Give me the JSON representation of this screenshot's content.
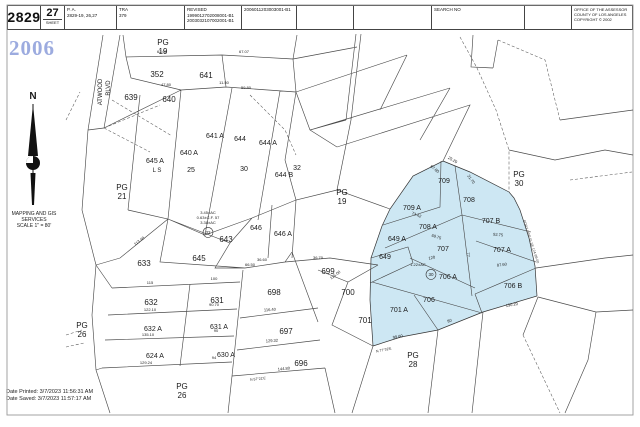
{
  "header": {
    "map_book": "2829",
    "sheet_value": "27",
    "sheet_label": "SHEET",
    "pa_label": "P. A.",
    "pa_value": "2829-19, 26,27",
    "tra_label": "TRA",
    "tra_value": "379",
    "revised_label": "REVISED",
    "revised_1": "1999012702008001-B1",
    "revised_2": "2003032107002001-B1",
    "revised_3": "2006011203003001-B1",
    "search_label": "SEARCH NO",
    "office_1": "OFFICE OF THE ASSESSOR",
    "office_2": "COUNTY OF LOS ANGELES",
    "office_3": "COPYRIGHT © 2002"
  },
  "sidebar": {
    "year": "2006",
    "org_1": "MAPPING AND GIS",
    "org_2": "SERVICES",
    "org_3": "SCALE 1\" = 80'",
    "date_printed": "Date Printed: 3/7/2023 11:56:31 AM",
    "date_saved": "Date Saved: 3/7/2023 11:57:17 AM"
  },
  "map": {
    "highlight_color": "#cde7f3",
    "labels": [
      {
        "t": "N",
        "x": 33,
        "y": 99,
        "s": 10,
        "b": true,
        "n": "north-label"
      },
      {
        "t": "PG",
        "x": 163,
        "y": 45,
        "s": 8
      },
      {
        "t": "19",
        "x": 163,
        "y": 54,
        "s": 8
      },
      {
        "t": "ATWOOD",
        "x": 102,
        "y": 92,
        "s": 6,
        "r": -90,
        "n": "street-label"
      },
      {
        "t": "BLVD",
        "x": 110,
        "y": 88,
        "s": 6,
        "r": -90,
        "n": "street-label"
      },
      {
        "t": "352",
        "x": 157,
        "y": 77,
        "s": 8
      },
      {
        "t": "641",
        "x": 206,
        "y": 78,
        "s": 8
      },
      {
        "t": "639",
        "x": 131,
        "y": 100,
        "s": 8
      },
      {
        "t": "640",
        "x": 169,
        "y": 102,
        "s": 8
      },
      {
        "t": "641 A",
        "x": 215,
        "y": 138,
        "s": 7
      },
      {
        "t": "644",
        "x": 240,
        "y": 141,
        "s": 7
      },
      {
        "t": "644 A",
        "x": 268,
        "y": 145,
        "s": 7
      },
      {
        "t": "640 A",
        "x": 189,
        "y": 155,
        "s": 7
      },
      {
        "t": "645 A",
        "x": 155,
        "y": 163,
        "s": 7
      },
      {
        "t": "L S",
        "x": 157,
        "y": 172,
        "s": 6
      },
      {
        "t": "25",
        "x": 191,
        "y": 172,
        "s": 7
      },
      {
        "t": "30",
        "x": 244,
        "y": 171,
        "s": 7
      },
      {
        "t": "32",
        "x": 297,
        "y": 170,
        "s": 7
      },
      {
        "t": "644 B",
        "x": 284,
        "y": 177,
        "s": 7
      },
      {
        "t": "PG",
        "x": 122,
        "y": 190,
        "s": 8
      },
      {
        "t": "21",
        "x": 122,
        "y": 199,
        "s": 8
      },
      {
        "t": "PG",
        "x": 342,
        "y": 195,
        "s": 8
      },
      {
        "t": "19",
        "x": 342,
        "y": 204,
        "s": 8
      },
      {
        "t": "PG",
        "x": 519,
        "y": 177,
        "s": 8
      },
      {
        "t": "30",
        "x": 519,
        "y": 186,
        "s": 8
      },
      {
        "t": "3.45±AC",
        "x": 208,
        "y": 214,
        "s": 4
      },
      {
        "t": "0.63±C.F. 57",
        "x": 208,
        "y": 219,
        "s": 4
      },
      {
        "t": "3.38±AC",
        "x": 208,
        "y": 224,
        "s": 4
      },
      {
        "t": "32",
        "x": 208,
        "y": 234,
        "s": 4.5,
        "circle": true
      },
      {
        "t": "643",
        "x": 226,
        "y": 242,
        "s": 8
      },
      {
        "t": "646",
        "x": 256,
        "y": 230,
        "s": 7
      },
      {
        "t": "646 A",
        "x": 283,
        "y": 236,
        "s": 7
      },
      {
        "t": "645",
        "x": 199,
        "y": 261,
        "s": 8
      },
      {
        "t": "633",
        "x": 144,
        "y": 266,
        "s": 8
      },
      {
        "t": "632",
        "x": 151,
        "y": 305,
        "s": 8
      },
      {
        "t": "631",
        "x": 217,
        "y": 303,
        "s": 8
      },
      {
        "t": "632 A",
        "x": 153,
        "y": 331,
        "s": 7
      },
      {
        "t": "631 A",
        "x": 219,
        "y": 329,
        "s": 7
      },
      {
        "t": "624 A",
        "x": 155,
        "y": 358,
        "s": 7
      },
      {
        "t": "630 A",
        "x": 226,
        "y": 357,
        "s": 7
      },
      {
        "t": "PG",
        "x": 82,
        "y": 328,
        "s": 8
      },
      {
        "t": "26",
        "x": 82,
        "y": 337,
        "s": 8
      },
      {
        "t": "PG",
        "x": 182,
        "y": 389,
        "s": 8
      },
      {
        "t": "26",
        "x": 182,
        "y": 398,
        "s": 8
      },
      {
        "t": "698",
        "x": 274,
        "y": 295,
        "s": 8
      },
      {
        "t": "699",
        "x": 328,
        "y": 274,
        "s": 8
      },
      {
        "t": "700",
        "x": 348,
        "y": 295,
        "s": 8
      },
      {
        "t": "697",
        "x": 286,
        "y": 334,
        "s": 8
      },
      {
        "t": "696",
        "x": 301,
        "y": 366,
        "s": 8
      },
      {
        "t": "701",
        "x": 365,
        "y": 323,
        "s": 8
      },
      {
        "t": "PG",
        "x": 413,
        "y": 358,
        "s": 8
      },
      {
        "t": "28",
        "x": 413,
        "y": 367,
        "s": 8
      },
      {
        "t": "709",
        "x": 444,
        "y": 183,
        "s": 7
      },
      {
        "t": "709 A",
        "x": 412,
        "y": 210,
        "s": 7
      },
      {
        "t": "708",
        "x": 469,
        "y": 202,
        "s": 7
      },
      {
        "t": "708 A",
        "x": 428,
        "y": 229,
        "s": 7
      },
      {
        "t": "707 B",
        "x": 491,
        "y": 223,
        "s": 7
      },
      {
        "t": "707",
        "x": 443,
        "y": 251,
        "s": 7
      },
      {
        "t": "707 A",
        "x": 502,
        "y": 252,
        "s": 7
      },
      {
        "t": "649 A",
        "x": 397,
        "y": 241,
        "s": 7
      },
      {
        "t": "649",
        "x": 385,
        "y": 259,
        "s": 7
      },
      {
        "t": "1.22±AC",
        "x": 418,
        "y": 266,
        "s": 4
      },
      {
        "t": "30",
        "x": 431,
        "y": 276,
        "s": 4.5,
        "circle": true
      },
      {
        "t": "706 A",
        "x": 448,
        "y": 279,
        "s": 7
      },
      {
        "t": "706",
        "x": 429,
        "y": 302,
        "s": 7
      },
      {
        "t": "706 B",
        "x": 513,
        "y": 288,
        "s": 7
      },
      {
        "t": "701 A",
        "x": 399,
        "y": 312,
        "s": 7
      },
      {
        "t": "BDRY LINE IS SE 124-99-00",
        "x": 530,
        "y": 242,
        "s": 3.5,
        "r": 72,
        "c": "#444",
        "n": "boundary-note"
      },
      {
        "t": "62.60",
        "x": 162,
        "y": 53,
        "s": 4,
        "n": "dimension"
      },
      {
        "t": "67.07",
        "x": 244,
        "y": 53,
        "s": 4,
        "n": "dimension"
      },
      {
        "t": "47.80",
        "x": 166,
        "y": 86,
        "s": 4,
        "n": "dimension"
      },
      {
        "t": "11.50",
        "x": 224,
        "y": 84,
        "s": 4,
        "n": "dimension"
      },
      {
        "t": "59.80",
        "x": 246,
        "y": 89,
        "s": 4,
        "n": "dimension"
      },
      {
        "t": "113.48",
        "x": 140,
        "y": 242,
        "s": 4,
        "r": -38,
        "n": "dimension"
      },
      {
        "t": "115",
        "x": 150,
        "y": 284,
        "s": 4,
        "n": "dimension"
      },
      {
        "t": "100",
        "x": 214,
        "y": 280,
        "s": 4,
        "n": "dimension"
      },
      {
        "t": "122.10",
        "x": 150,
        "y": 311,
        "s": 4,
        "n": "dimension"
      },
      {
        "t": "90.70",
        "x": 214,
        "y": 306,
        "s": 4,
        "n": "dimension"
      },
      {
        "t": "135.10",
        "x": 148,
        "y": 336,
        "s": 4,
        "n": "dimension"
      },
      {
        "t": "90",
        "x": 216,
        "y": 332,
        "s": 4,
        "n": "dimension"
      },
      {
        "t": "129.24",
        "x": 146,
        "y": 364,
        "s": 4,
        "n": "dimension"
      },
      {
        "t": "94",
        "x": 214,
        "y": 359,
        "s": 4,
        "n": "dimension"
      },
      {
        "t": "116.40",
        "x": 270,
        "y": 311,
        "s": 4,
        "r": -4,
        "n": "dimension"
      },
      {
        "t": "129.32",
        "x": 272,
        "y": 342,
        "s": 4,
        "r": -4,
        "n": "dimension"
      },
      {
        "t": "144.80",
        "x": 284,
        "y": 370,
        "s": 4,
        "r": -6,
        "n": "dimension"
      },
      {
        "t": "N 57°21'E",
        "x": 258,
        "y": 380,
        "s": 3.5,
        "r": -6,
        "n": "dimension"
      },
      {
        "t": "115.00",
        "x": 336,
        "y": 276,
        "s": 4,
        "r": -38,
        "n": "dimension"
      },
      {
        "t": "36.60",
        "x": 262,
        "y": 261,
        "s": 4,
        "n": "dimension"
      },
      {
        "t": "66.50",
        "x": 250,
        "y": 266,
        "s": 4,
        "n": "dimension"
      },
      {
        "t": "36.70",
        "x": 318,
        "y": 259,
        "s": 4,
        "n": "dimension"
      },
      {
        "t": "99.60",
        "x": 398,
        "y": 338,
        "s": 4,
        "r": -10,
        "n": "dimension"
      },
      {
        "t": "N 77°32'E",
        "x": 384,
        "y": 351,
        "s": 3.5,
        "r": -12,
        "n": "dimension"
      },
      {
        "t": "67.80",
        "x": 434,
        "y": 170,
        "s": 4,
        "r": 38,
        "n": "dimension"
      },
      {
        "t": "25.20",
        "x": 452,
        "y": 161,
        "s": 4,
        "r": 30,
        "n": "dimension"
      },
      {
        "t": "21.70",
        "x": 470,
        "y": 180,
        "s": 4,
        "r": 55,
        "n": "dimension"
      },
      {
        "t": "73.42",
        "x": 416,
        "y": 216,
        "s": 4,
        "r": 22,
        "n": "dimension"
      },
      {
        "t": "69.75",
        "x": 436,
        "y": 238,
        "s": 4,
        "r": 18,
        "n": "dimension"
      },
      {
        "t": "92.75",
        "x": 498,
        "y": 236,
        "s": 4,
        "r": 6,
        "n": "dimension"
      },
      {
        "t": "87.60",
        "x": 502,
        "y": 266,
        "s": 4,
        "r": -7,
        "n": "dimension"
      },
      {
        "t": "130.20",
        "x": 512,
        "y": 306,
        "s": 4,
        "r": -10,
        "n": "dimension"
      },
      {
        "t": "77",
        "x": 467,
        "y": 255,
        "s": 4,
        "r": 80,
        "n": "dimension"
      },
      {
        "t": "120",
        "x": 432,
        "y": 259,
        "s": 4,
        "r": -10,
        "n": "dimension"
      },
      {
        "t": "80",
        "x": 450,
        "y": 322,
        "s": 4,
        "r": -20,
        "n": "dimension"
      }
    ]
  }
}
